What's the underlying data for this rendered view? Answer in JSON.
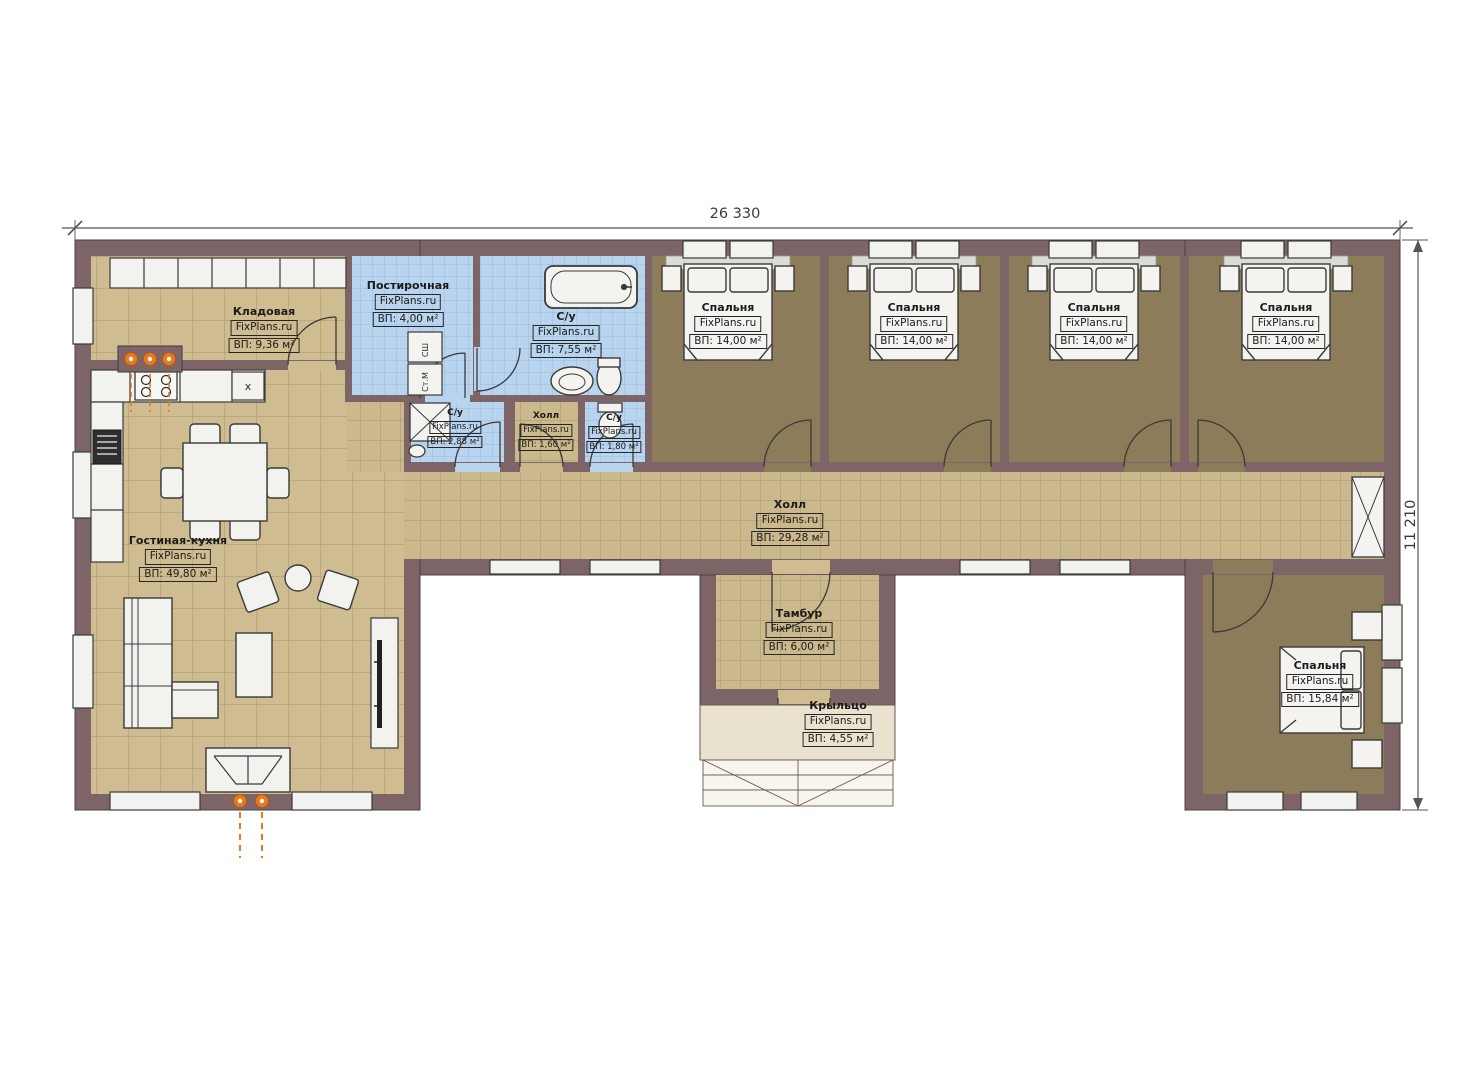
{
  "plan": {
    "dimensions": {
      "width_label": "26 330",
      "height_label": "11 210"
    },
    "watermark": "FixPlans.ru",
    "colors": {
      "wall": "#7d6567",
      "tile_floor": "#cfbc90",
      "tile_grid": "#a8946a",
      "bath_floor": "#b9d4ee",
      "bath_grid": "#90b6da",
      "bedroom_floor": "#8d7c59",
      "porch_floor": "#e9e2cf",
      "furniture": "#f2f2ef",
      "outline": "#3a3a3a",
      "accent_orange": "#e8791e"
    },
    "rooms": [
      {
        "id": "storage",
        "name": "Кладовая",
        "area": "ВП: 9,36 м²"
      },
      {
        "id": "laundry",
        "name": "Постирочная",
        "area": "ВП: 4,00 м²"
      },
      {
        "id": "bathroom-main",
        "name": "С/у",
        "area": "ВП: 7,55 м²"
      },
      {
        "id": "bedroom-1",
        "name": "Спальня",
        "area": "ВП: 14,00 м²"
      },
      {
        "id": "bedroom-2",
        "name": "Спальня",
        "area": "ВП: 14,00 м²"
      },
      {
        "id": "bedroom-3",
        "name": "Спальня",
        "area": "ВП: 14,00 м²"
      },
      {
        "id": "bedroom-4",
        "name": "Спальня",
        "area": "ВП: 14,00 м²"
      },
      {
        "id": "shower-room",
        "name": "С/у",
        "area": "ВП: 2,88 м²"
      },
      {
        "id": "hall-small",
        "name": "Холл",
        "area": "ВП: 1,60 м²"
      },
      {
        "id": "wc-small",
        "name": "С/у",
        "area": "ВП: 1,80 м²"
      },
      {
        "id": "hall-main",
        "name": "Холл",
        "area": "ВП: 29,28 м²"
      },
      {
        "id": "living-kitchen",
        "name": "Гостиная-кухня",
        "area": "ВП: 49,80 м²"
      },
      {
        "id": "vestibule",
        "name": "Тамбур",
        "area": "ВП: 6,00 м²"
      },
      {
        "id": "porch",
        "name": "Крыльцо",
        "area": "ВП: 4,55 м²"
      },
      {
        "id": "bedroom-5",
        "name": "Спальня",
        "area": "ВП: 15,84 м²"
      }
    ],
    "appliances": {
      "dryer": "СШ",
      "washer": "Ст.М",
      "sink_unit": "x"
    }
  }
}
